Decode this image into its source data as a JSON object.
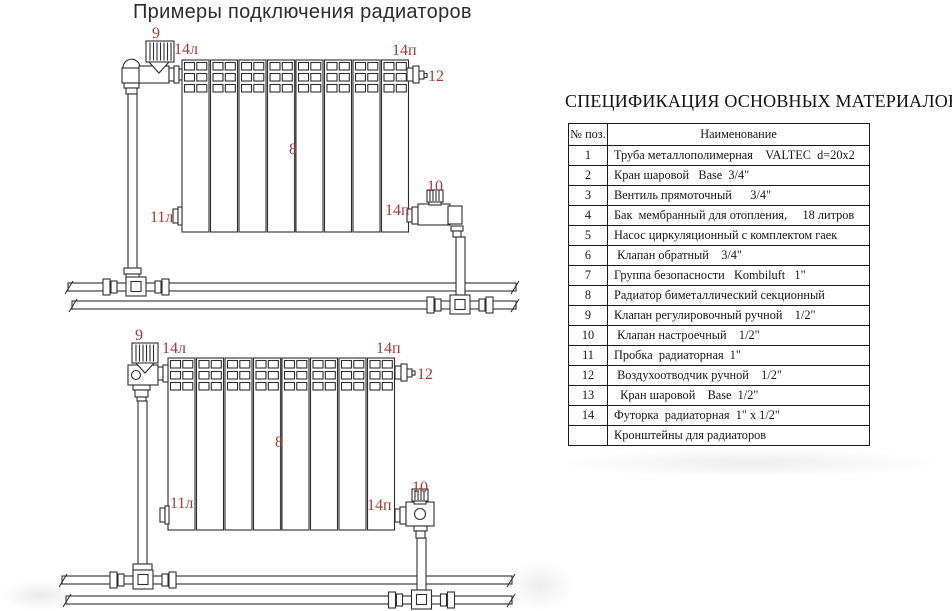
{
  "diagrams": {
    "title": "Примеры подключения радиаторов",
    "label_color": "#a93a3a",
    "line_color": "#2e2e2e",
    "labels": {
      "pos9": "9",
      "pos14l": "14л",
      "pos14p": "14п",
      "pos12": "12",
      "pos8": "8",
      "pos11l": "11л",
      "pos10": "10"
    }
  },
  "spec": {
    "title": "СПЕЦИФИКАЦИЯ ОСНОВНЫХ МАТЕРИАЛОВ",
    "headers": {
      "num": "№ поз.",
      "name": "Наименование"
    },
    "rows": [
      {
        "num": "1",
        "name": "Труба металлополимерная    VALTEC  d=20x2"
      },
      {
        "num": "2",
        "name": "Кран шаровой   Base  3/4\""
      },
      {
        "num": "3",
        "name": "Вентиль прямоточный      3/4\""
      },
      {
        "num": "4",
        "name": "Бак  мембранный для отопления,     18 литров"
      },
      {
        "num": "5",
        "name": "Насос циркуляционный с комплектом гаек"
      },
      {
        "num": "6",
        "name": " Клапан обратный    3/4\""
      },
      {
        "num": "7",
        "name": "Группа безопасности   Kombiluft   1\""
      },
      {
        "num": "8",
        "name": "Радиатор биметаллический секционный"
      },
      {
        "num": "9",
        "name": "Клапан регулировочный ручной    1/2\""
      },
      {
        "num": "10",
        "name": " Клапан настроечный    1/2\""
      },
      {
        "num": "11",
        "name": "Пробка  радиаторная  1\""
      },
      {
        "num": "12",
        "name": " Воздухоотводчик ручной    1/2\""
      },
      {
        "num": "13",
        "name": "  Кран шаровой    Base  1/2\""
      },
      {
        "num": "14",
        "name": "Футорка  радиаторная  1\" х 1/2\""
      },
      {
        "num": "",
        "name": "Кронштейны для радиаторов"
      }
    ]
  }
}
